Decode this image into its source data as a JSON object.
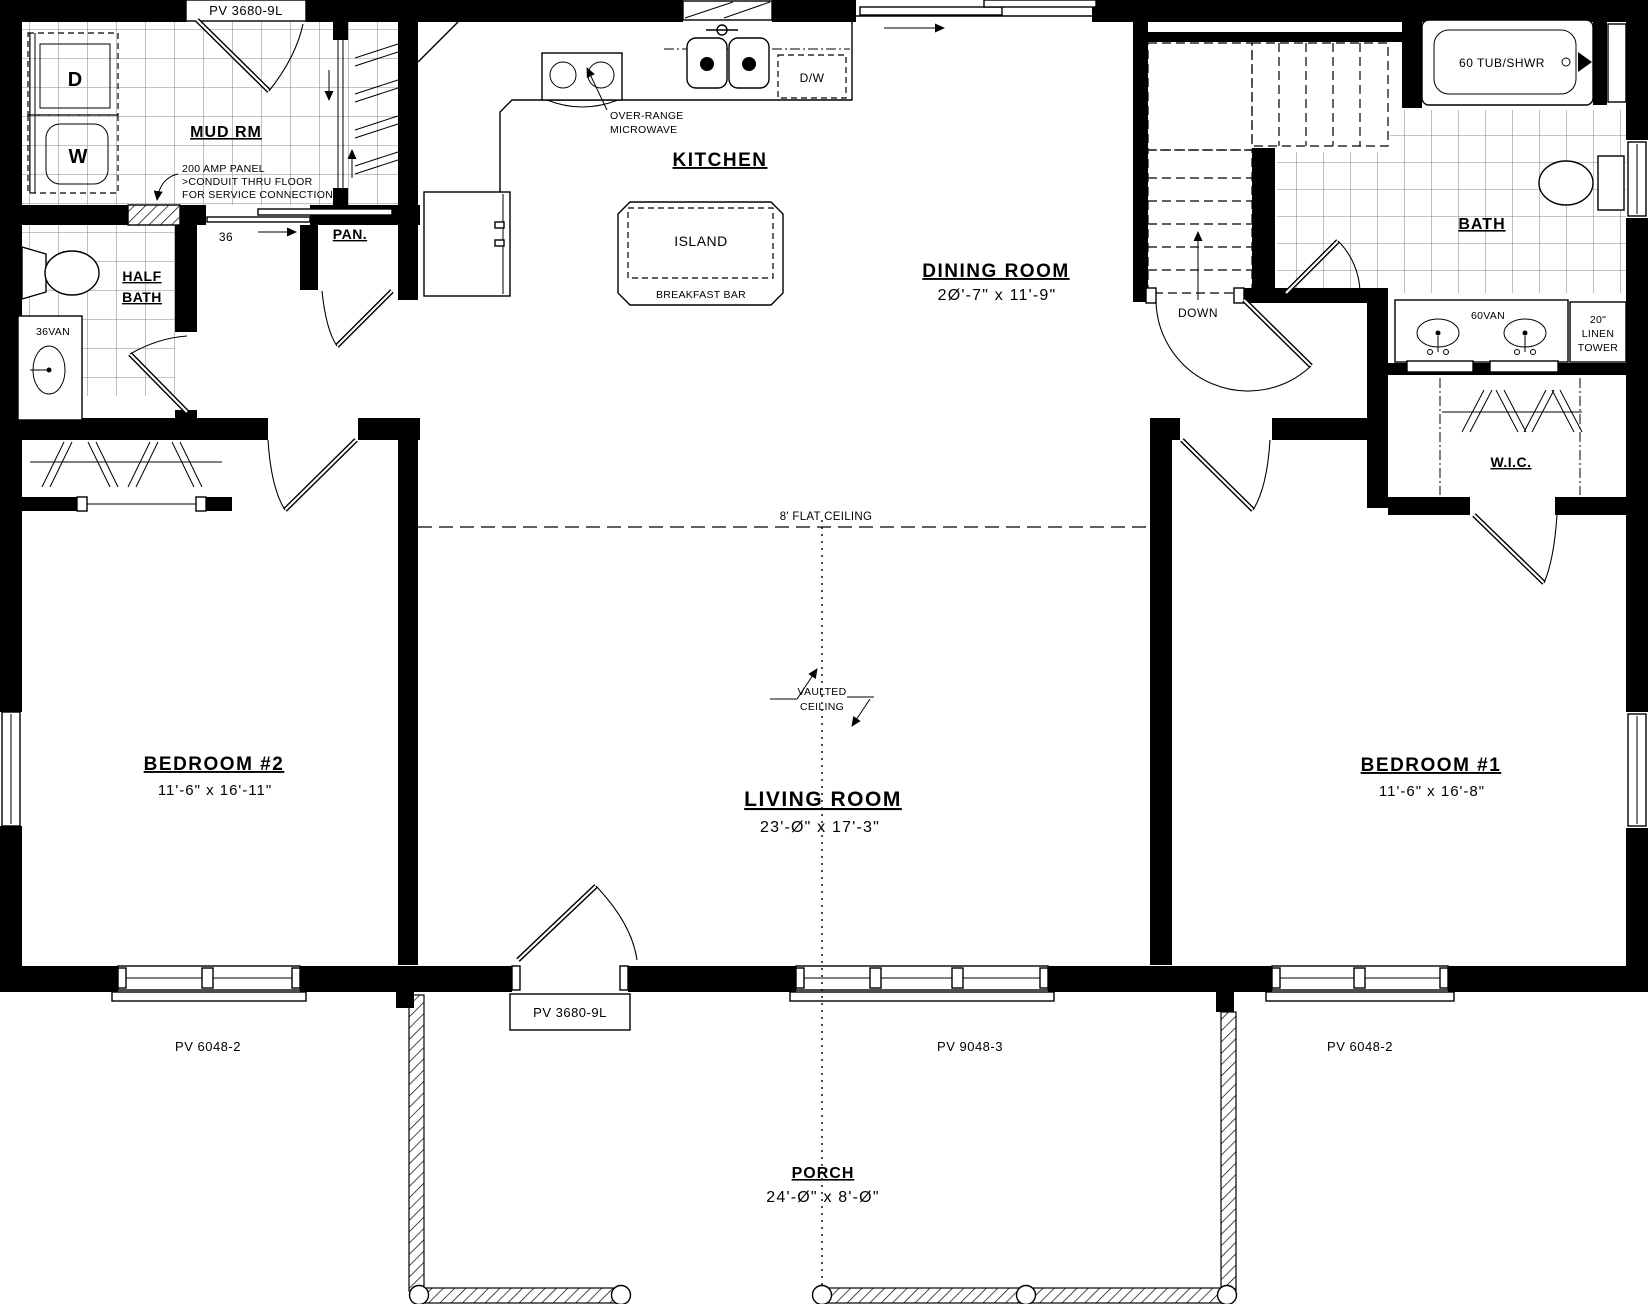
{
  "plan": {
    "rooms": {
      "mud": {
        "label": "MUD RM"
      },
      "half_bath": {
        "line1": "HALF",
        "line2": "BATH"
      },
      "pantry": {
        "label": "PAN."
      },
      "kitchen": {
        "label": "KITCHEN"
      },
      "dining": {
        "label": "DINING ROOM",
        "dims": "2Ø'-7\" x 11'-9\""
      },
      "bath": {
        "label": "BATH"
      },
      "wic": {
        "label": "W.I.C."
      },
      "bedroom2": {
        "label": "BEDROOM #2",
        "dims": "11'-6\" x 16'-11\""
      },
      "living": {
        "label": "LIVING ROOM",
        "dims": "23'-Ø\" x 17'-3\""
      },
      "bedroom1": {
        "label": "BEDROOM #1",
        "dims": "11'-6\" x 16'-8\""
      },
      "porch": {
        "label": "PORCH",
        "dims": "24'-Ø\" x 8'-Ø\""
      }
    },
    "fixtures": {
      "dryer": "D",
      "washer": "W",
      "dishwasher": "D/W",
      "range_note1": "OVER-RANGE",
      "range_note2": "MICROWAVE",
      "island": "ISLAND",
      "breakfast_bar": "BREAKFAST BAR",
      "tub": "60 TUB/SHWR",
      "vanity60": "60VAN",
      "vanity36": "36VAN",
      "linen1": "20\"",
      "linen2": "LINEN",
      "linen3": "TOWER",
      "down": "DOWN",
      "door_width": "36",
      "panel1": "200 AMP PANEL",
      "panel2": ">CONDUIT THRU FLOOR",
      "panel3": "FOR SERVICE CONNECTION"
    },
    "ceilings": {
      "flat": "8' FLAT CEILING",
      "vaulted1": "VAULTED",
      "vaulted2": "CEILING"
    },
    "openings": {
      "mud_door": "PV 3680-9L",
      "front_door": "PV 3680-9L",
      "bedroom2_window": "PV 6048-2",
      "living_window": "PV 9048-3",
      "bedroom1_window": "PV 6048-2"
    },
    "colors": {
      "ink": "#000000",
      "paper": "#ffffff",
      "tile": "#8a8a8a"
    }
  }
}
